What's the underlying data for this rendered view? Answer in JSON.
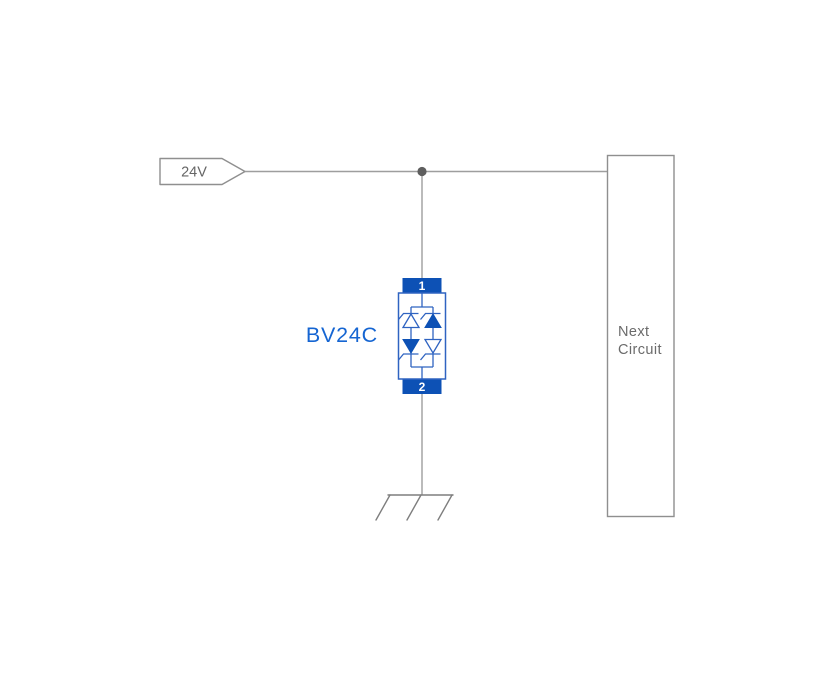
{
  "schematic": {
    "power_tag": {
      "label": "24V"
    },
    "protection_device": {
      "label": "BV24C",
      "pin_top_label": "1",
      "pin_bottom_label": "2",
      "symbol": "bidirectional-tvs-diode-array"
    },
    "next_circuit_block": {
      "label_line1": "Next",
      "label_line2": "Circuit"
    },
    "ground_symbol": "chassis-ground-icon",
    "colors": {
      "device_blue": "#0d51b5",
      "device_stroke_blue": "#2f63c1",
      "device_label_blue": "#1565d2",
      "wire_gray": "#9e9e9e",
      "outline_gray": "#8f8f8f",
      "text_gray": "#666666",
      "box_text_gray": "#6b6b6b",
      "junction_gray": "#5e5e5e",
      "background": "#ffffff"
    }
  }
}
